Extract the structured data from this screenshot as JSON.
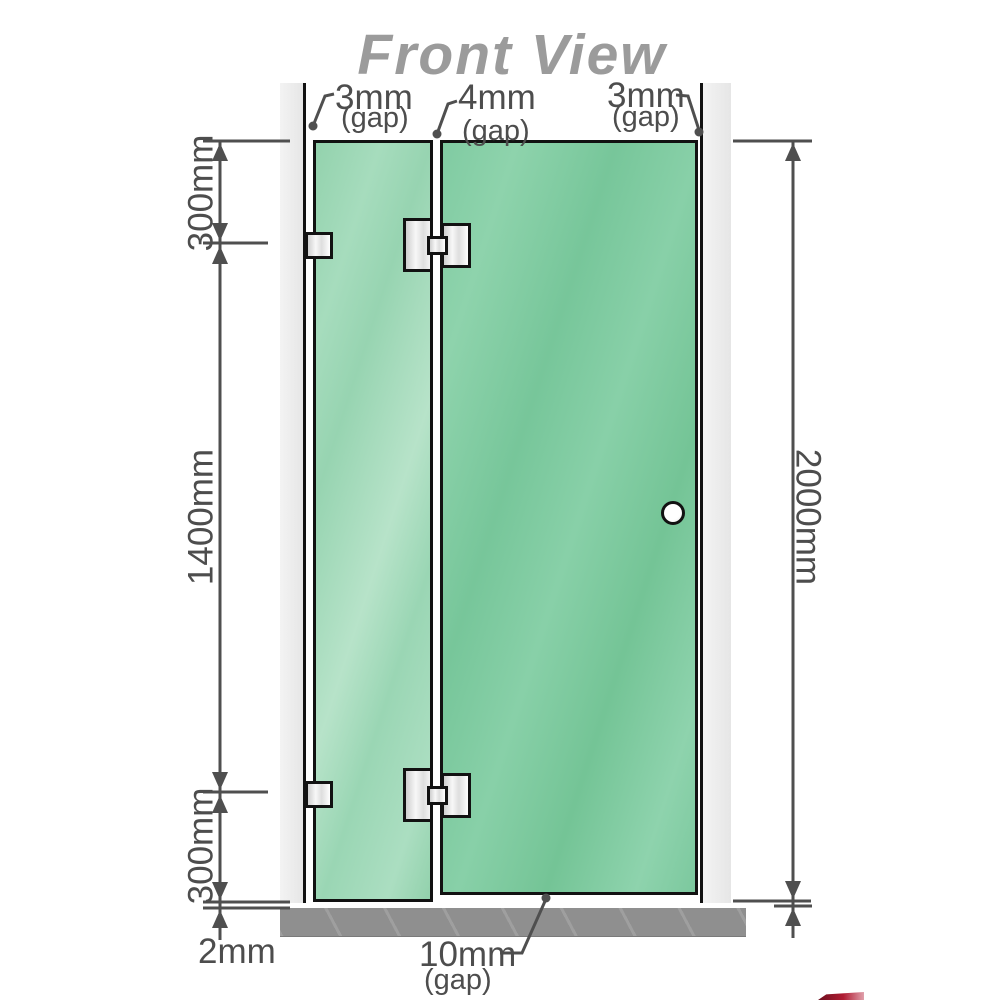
{
  "title": "Front View",
  "labels": {
    "gap_left": {
      "value": "3mm",
      "unit": "(gap)"
    },
    "gap_mid": {
      "value": "4mm",
      "unit": "(gap)"
    },
    "gap_right": {
      "value": "3mm",
      "unit": "(gap)"
    },
    "height_top": "300mm",
    "height_mid": "1400mm",
    "height_bottom": "300mm",
    "total_height": "2000mm",
    "floor_gap": "2mm",
    "door_gap": {
      "value": "10mm",
      "unit": "(gap)"
    }
  },
  "colors": {
    "glass_fixed": "#9ed7b6",
    "glass_door": "#7fcba3",
    "wall_post": "#ececec",
    "floor": "#8f8f8f",
    "outline": "#121212",
    "dimension": "#4d4d4d",
    "title": "#9b9b9b",
    "hardware": "#e8e8e8"
  }
}
